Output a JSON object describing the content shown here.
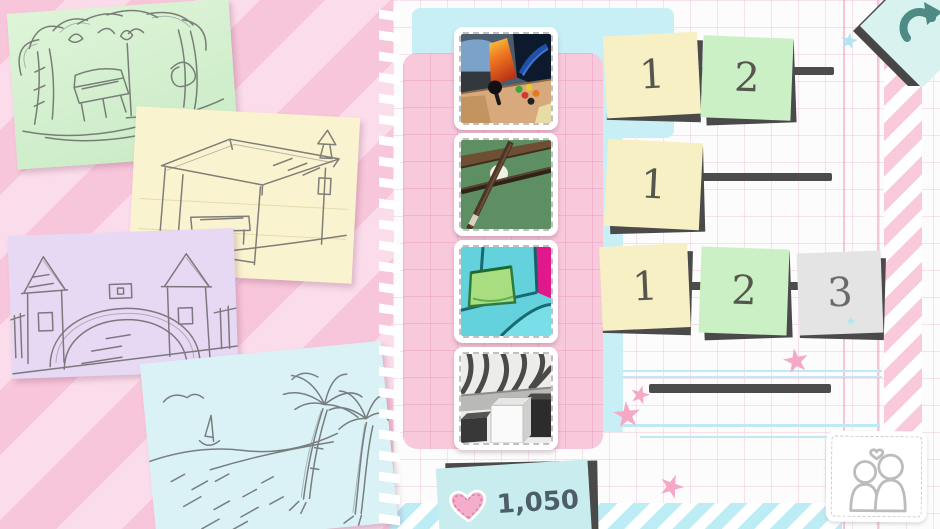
{
  "screen": {
    "name": "level-select",
    "width": 940,
    "height": 529
  },
  "palette": {
    "bg_stripe_dark": "#f8c6da",
    "bg_stripe_light": "#fbdcea",
    "paper": "#fcfcfc",
    "grid_line": "#f3bcd4",
    "panel_pink": "#f8c8db",
    "accent_cyan": "#c8eff5",
    "note_backing": "#4a4a4a",
    "track_line": "#4c4c4c",
    "note_yellow": "#f7f0c5",
    "note_green": "#cbf0c6",
    "note_gray": "#e4e4e4"
  },
  "sketch_cards": [
    {
      "name": "park-bench-sketch",
      "paper_color": "#d4f0cd"
    },
    {
      "name": "bus-stop-sketch",
      "paper_color": "#faf3d0"
    },
    {
      "name": "castle-gate-sketch",
      "paper_color": "#e7d9f3"
    },
    {
      "name": "beach-palms-sketch",
      "paper_color": "#daf2f6"
    }
  ],
  "puzzle_sets": [
    {
      "name": "arcade-machine"
    },
    {
      "name": "billiard-cues"
    },
    {
      "name": "couch-pillow"
    },
    {
      "name": "monochrome-room"
    }
  ],
  "level_rows": [
    {
      "notes": [
        {
          "label": "1",
          "color": "yellow"
        },
        {
          "label": "2",
          "color": "green"
        }
      ]
    },
    {
      "notes": [
        {
          "label": "1",
          "color": "yellow"
        }
      ]
    },
    {
      "notes": [
        {
          "label": "1",
          "color": "yellow"
        },
        {
          "label": "2",
          "color": "green"
        },
        {
          "label": "3",
          "color": "gray"
        }
      ]
    },
    {
      "notes": []
    }
  ],
  "hud": {
    "restart_button": {
      "icon": "undo-arrow-icon"
    },
    "score": {
      "icon": "heart-icon",
      "value": "1,050"
    },
    "multiplayer_button": {
      "icon": "couple-heart-icon"
    }
  }
}
